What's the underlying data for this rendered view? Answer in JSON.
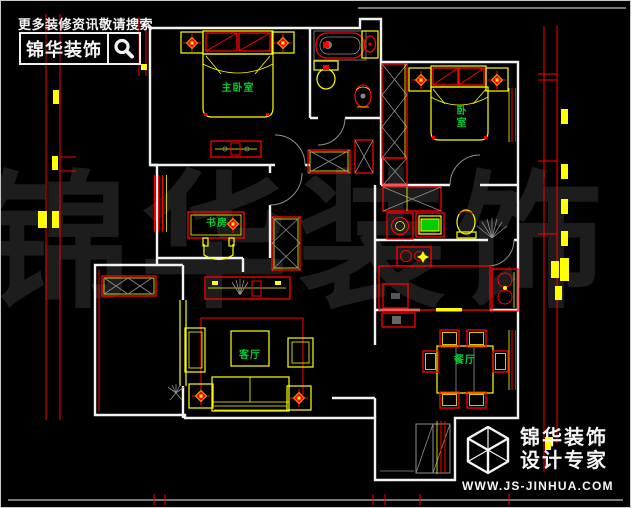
{
  "canvas": {
    "width": 631,
    "height": 508,
    "background": "#000000"
  },
  "header": {
    "tagline": "更多装修资讯敬请搜索",
    "brand_name": "锦华装饰",
    "search_icon": "magnifier"
  },
  "watermark": {
    "text": "锦华装饰"
  },
  "floor_plan": {
    "rooms": [
      {
        "id": "master-bedroom",
        "label": "主卧室"
      },
      {
        "id": "bedroom",
        "label": "卧室"
      },
      {
        "id": "study",
        "label": "书房"
      },
      {
        "id": "living-room",
        "label": "客厅"
      },
      {
        "id": "dining-room",
        "label": "餐厅"
      }
    ]
  },
  "footer": {
    "logo_icon": "wireframe-cube",
    "brand_name": "锦华装饰",
    "slogan": "设计专家",
    "website": "WWW.JS-JINHUA.COM"
  },
  "colors": {
    "walls": "#f2f2f2",
    "furniture_red": "#ff0000",
    "furniture_yellow": "#ffff00",
    "room_label_green": "#00cc33",
    "detail_gray": "#8f8f8f",
    "watermark_gray": "#1d1d1d"
  }
}
